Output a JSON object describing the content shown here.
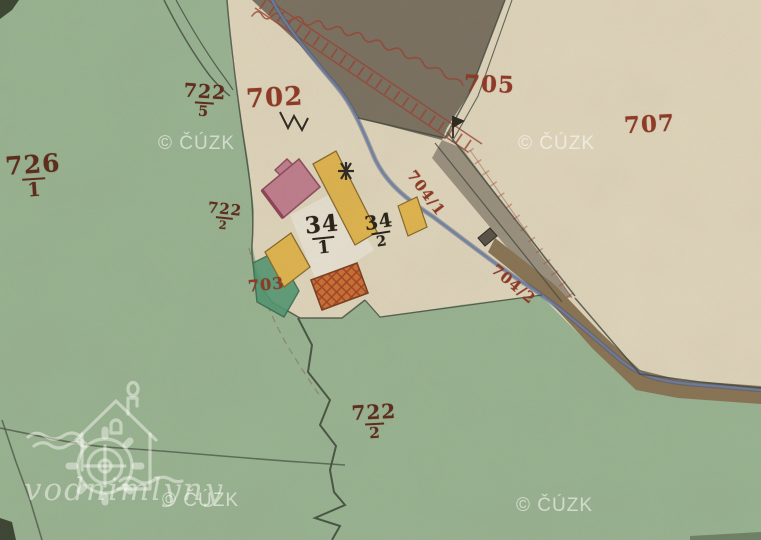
{
  "map": {
    "description": "historical hand-coloured cadastral map crop",
    "colors": {
      "meadow": "#9cba97",
      "field": "#e9dfc5",
      "dark_land": "#7b7162",
      "road": "#8a7454",
      "stream": "#6b7fae",
      "building_stone": "#c77f93",
      "building_wood": "#e9bb4d",
      "building_burnt": "#d2702f",
      "garden": "#4f9b74",
      "label_red": "#8f3a26",
      "label_maroon": "#5e2d1d",
      "label_black": "#2b241a"
    }
  },
  "labels": {
    "p726_1": {
      "num": "726",
      "den": "1"
    },
    "p722_5": {
      "num": "722",
      "den": "5"
    },
    "p702": {
      "text": "702"
    },
    "p722_2a": {
      "num": "722",
      "den": "2"
    },
    "p705": {
      "text": "705"
    },
    "p707": {
      "text": "707"
    },
    "p704_1": {
      "text": "704/1"
    },
    "p704_2": {
      "text": "704/2"
    },
    "p703": {
      "text": "703"
    },
    "h34_1": {
      "num": "34",
      "den": "1"
    },
    "h34_2": {
      "num": "34",
      "den": "2"
    },
    "p722_2b": {
      "num": "722",
      "den": "2"
    }
  },
  "watermarks": {
    "cuzk": "© ČÚZK",
    "site": "vodnimlyny"
  }
}
